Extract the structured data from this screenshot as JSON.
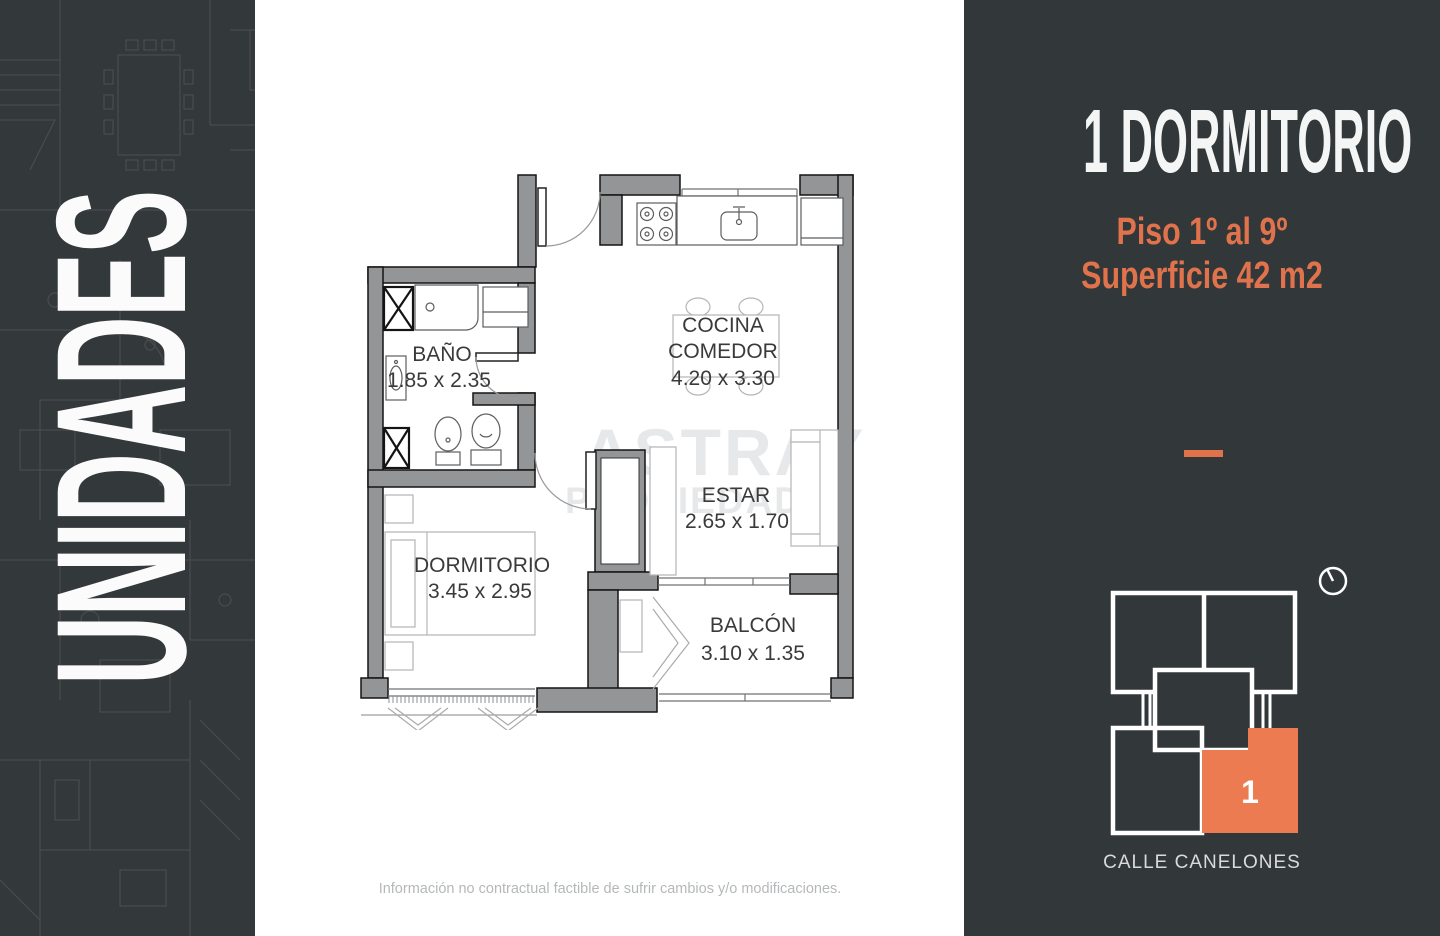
{
  "left_panel": {
    "vertical_label": "UNIDADES"
  },
  "main": {
    "watermark_line1": "ASTRAY",
    "watermark_line2": "PROPIEDADES",
    "disclaimer": "Información no contractual factible de sufrir cambios y/o modificaciones.",
    "floor_plan": {
      "bano": {
        "name": "BAÑO",
        "dims": "1.85 x 2.35"
      },
      "cocina": {
        "name": "COCINA",
        "name2": "COMEDOR",
        "dims": "4.20 x 3.30"
      },
      "estar": {
        "name": "ESTAR",
        "dims": "2.65 x 1.70"
      },
      "dormitorio": {
        "name": "DORMITORIO",
        "dims": "3.45 x 2.95"
      },
      "balcon": {
        "name": "BALCÓN",
        "dims": "3.10 x 1.35"
      }
    }
  },
  "right_panel": {
    "title": "1 DORMITORIO",
    "subtitle_line1": "Piso 1º al 9º",
    "subtitle_line2": "Superficie 42 m2",
    "unit_number": "1",
    "street_label": "CALLE CANELONES"
  },
  "colors": {
    "accent_orange": "#e0734b",
    "unit_orange": "#ec7b51",
    "panel_dark": "#32373a",
    "wall_gray": "#939597",
    "watermark_gray": "#e6e8ea"
  }
}
